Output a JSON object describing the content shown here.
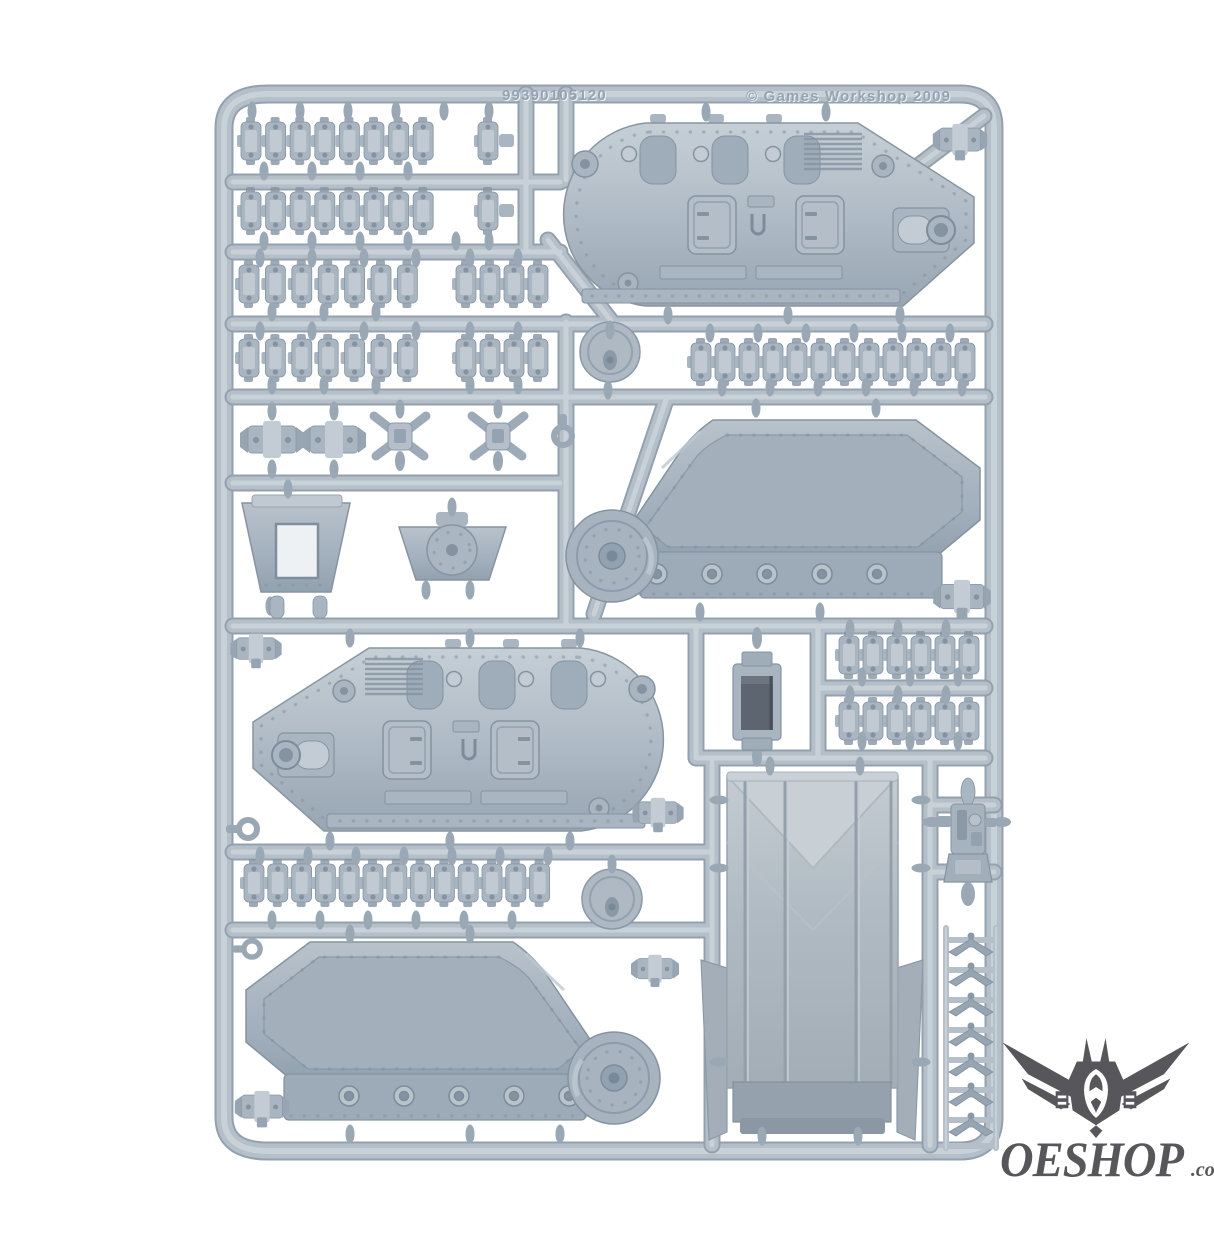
{
  "image": {
    "type": "product-photo",
    "subject": "Games Workshop plastic model kit sprue (tank frame) on white background"
  },
  "sprue": {
    "part_code": "99390105120",
    "copyright": "© Games Workshop 2009",
    "parts_inventory": [
      {
        "name": "track-link-strip",
        "count": 8
      },
      {
        "name": "single-track-link",
        "count": 2
      },
      {
        "name": "hull-side-panel",
        "count": 2
      },
      {
        "name": "track-guard-panel",
        "count": 2
      },
      {
        "name": "assault-ramp-door",
        "count": 1
      },
      {
        "name": "front-glacis-plate",
        "count": 1
      },
      {
        "name": "dome-plate",
        "count": 1
      },
      {
        "name": "round-hatch-disc",
        "count": 2
      },
      {
        "name": "vision-block-housing",
        "count": 1
      },
      {
        "name": "headlamp-cluster",
        "count": 2
      },
      {
        "name": "mounting-bracket",
        "count": 2
      },
      {
        "name": "pintle-clamp",
        "count": 6
      },
      {
        "name": "searchlight-assembly",
        "count": 1
      },
      {
        "name": "grab-handle",
        "count": 7
      },
      {
        "name": "towing-hook",
        "count": 3
      }
    ]
  },
  "watermark": {
    "brand": "OESHOP",
    "tld": ".co.uk"
  },
  "colors": {
    "background": "#ffffff",
    "runner": "#b4bfc9",
    "runner_light": "#cdd4da",
    "runner_dark": "#96a4b0",
    "part_light": "#c3ccd4",
    "part_mid": "#a9b5c1",
    "part_dark": "#8593a1",
    "panel_recess": "#9fadba",
    "emboss": "#93a3b1",
    "logo": "#57575b"
  }
}
